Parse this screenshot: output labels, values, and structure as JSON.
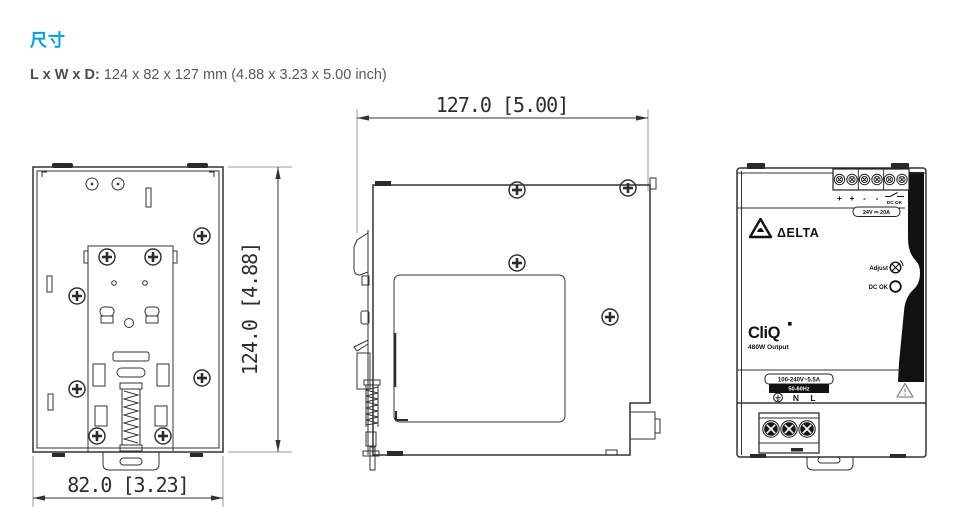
{
  "page": {
    "heading": "尺寸",
    "size_label": "L x W x D:",
    "size_value": "124 x 82 x 127 mm (4.88 x 3.23 x 5.00 inch)"
  },
  "dims": {
    "height": "124.0 [4.88]",
    "width": "82.0 [3.23]",
    "depth": "127.0 [5.00]"
  },
  "device": {
    "brand": "ΔELTA",
    "output_terminal_labels": [
      "+",
      "+",
      "-",
      "-"
    ],
    "dc_ok_contact_label": "DC OK",
    "output_rating": "24V ⎓ 20A",
    "adjust_label": "Adjust",
    "dc_ok_led_label": "DC OK",
    "series": "CliQ",
    "power": "480W Output",
    "input_rating": "100-240V~5.5A",
    "input_frequency": "50-60Hz",
    "input_terminal_n": "N",
    "input_terminal_l": "L"
  },
  "colors": {
    "accent": "#00a0e0",
    "line": "#333333",
    "ext_line": "#9c9c9c"
  }
}
